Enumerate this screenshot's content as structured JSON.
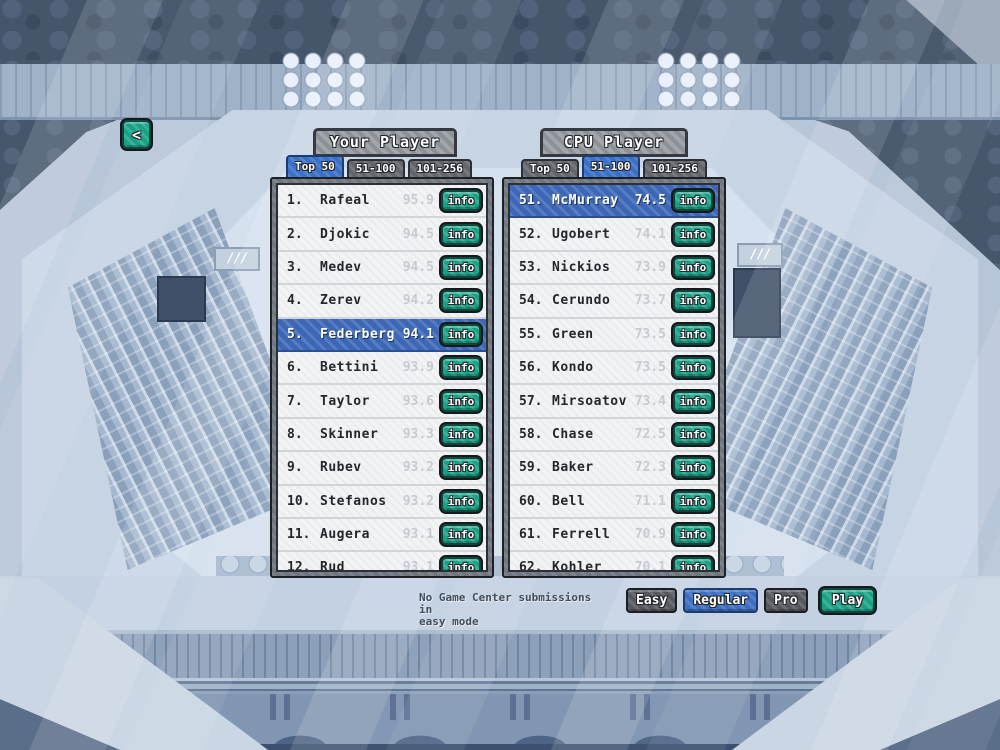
{
  "back_button": {
    "glyph": "<"
  },
  "labels": {
    "info": "info"
  },
  "decor": {
    "wall_mark": "///"
  },
  "panels": [
    {
      "title": "Your Player",
      "tabs": [
        {
          "label": "Top 50",
          "selected": true
        },
        {
          "label": "51-100",
          "selected": false
        },
        {
          "label": "101-256",
          "selected": false
        }
      ],
      "rows": [
        {
          "rank": "1.",
          "name": "Rafeal",
          "score": "95.9",
          "highlighted": false
        },
        {
          "rank": "2.",
          "name": "Djokic",
          "score": "94.5",
          "highlighted": false
        },
        {
          "rank": "3.",
          "name": "Medev",
          "score": "94.5",
          "highlighted": false
        },
        {
          "rank": "4.",
          "name": "Zerev",
          "score": "94.2",
          "highlighted": false
        },
        {
          "rank": "5.",
          "name": "Federberg",
          "score": "94.1",
          "highlighted": true
        },
        {
          "rank": "6.",
          "name": "Bettini",
          "score": "93.9",
          "highlighted": false
        },
        {
          "rank": "7.",
          "name": "Taylor",
          "score": "93.6",
          "highlighted": false
        },
        {
          "rank": "8.",
          "name": "Skinner",
          "score": "93.3",
          "highlighted": false
        },
        {
          "rank": "9.",
          "name": "Rubev",
          "score": "93.2",
          "highlighted": false
        },
        {
          "rank": "10.",
          "name": "Stefanos",
          "score": "93.2",
          "highlighted": false
        },
        {
          "rank": "11.",
          "name": "Augera",
          "score": "93.1",
          "highlighted": false
        },
        {
          "rank": "12.",
          "name": "Rud",
          "score": "93.1",
          "highlighted": false
        }
      ]
    },
    {
      "title": "CPU Player",
      "tabs": [
        {
          "label": "Top 50",
          "selected": false
        },
        {
          "label": "51-100",
          "selected": true
        },
        {
          "label": "101-256",
          "selected": false
        }
      ],
      "rows": [
        {
          "rank": "51.",
          "name": "McMurray",
          "score": "74.5",
          "highlighted": true
        },
        {
          "rank": "52.",
          "name": "Ugobert",
          "score": "74.1",
          "highlighted": false
        },
        {
          "rank": "53.",
          "name": "Nickios",
          "score": "73.9",
          "highlighted": false
        },
        {
          "rank": "54.",
          "name": "Cerundo",
          "score": "73.7",
          "highlighted": false
        },
        {
          "rank": "55.",
          "name": "Green",
          "score": "73.5",
          "highlighted": false
        },
        {
          "rank": "56.",
          "name": "Kondo",
          "score": "73.5",
          "highlighted": false
        },
        {
          "rank": "57.",
          "name": "Mirsoatov",
          "score": "73.4",
          "highlighted": false
        },
        {
          "rank": "58.",
          "name": "Chase",
          "score": "72.5",
          "highlighted": false
        },
        {
          "rank": "59.",
          "name": "Baker",
          "score": "72.3",
          "highlighted": false
        },
        {
          "rank": "60.",
          "name": "Bell",
          "score": "71.1",
          "highlighted": false
        },
        {
          "rank": "61.",
          "name": "Ferrell",
          "score": "70.9",
          "highlighted": false
        },
        {
          "rank": "62.",
          "name": "Kohler",
          "score": "70.1",
          "highlighted": false
        }
      ]
    }
  ],
  "footer": {
    "note_line1": "No Game Center submissions in",
    "note_line2": "easy mode",
    "difficulty": [
      {
        "label": "Easy",
        "selected": false
      },
      {
        "label": "Regular",
        "selected": true
      },
      {
        "label": "Pro",
        "selected": false
      }
    ],
    "play_label": "Play"
  },
  "colors": {
    "accent_teal": "#17a185",
    "accent_blue": "#3b6fc4",
    "row_highlight_blue": "#3b67b6",
    "tab_grey": "#62666c",
    "header_grey": "#94999f",
    "score_grey": "#c6cbd2",
    "list_bg": "#f2f3f5"
  }
}
